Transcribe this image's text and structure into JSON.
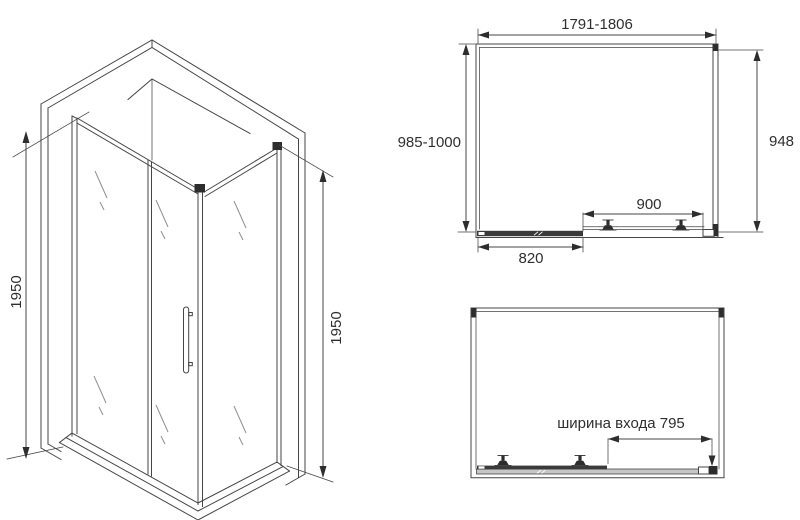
{
  "page": {
    "background": "#ffffff",
    "colors": {
      "line": "#454545",
      "dark": "#2d2d2d",
      "text": "#2f2f2f",
      "glass": "#8f8f8f",
      "track": "#c6c6c6",
      "bar": "#3a3a3a"
    }
  },
  "iso_view": {
    "label": "isometric view of corner shower enclosure",
    "height_left": "1950",
    "height_right": "1950"
  },
  "top_view": {
    "label": "top plan view",
    "overall_width": "1791-1806",
    "overall_depth": "985-1000",
    "side_panel": "948",
    "door_panel": "900",
    "fixed_panel": "820"
  },
  "open_view": {
    "label": "plan view with door slid open",
    "entrance_width": "ширина входа 795"
  }
}
